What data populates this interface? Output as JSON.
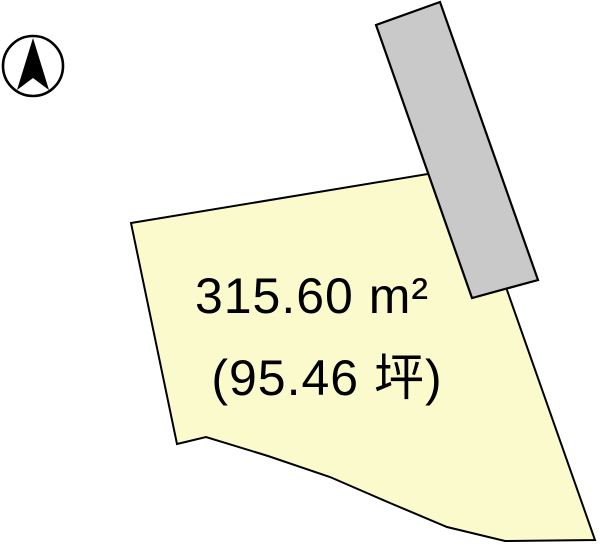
{
  "canvas": {
    "width_px": 600,
    "height_px": 545,
    "background_color": "#FFFFFF"
  },
  "compass": {
    "icon": "north-arrow-icon",
    "color": "#000000"
  },
  "plot": {
    "area_sqm_label": "315.60 m²",
    "area_tsubo_label": "(95.46 坪)",
    "area_sqm": 315.6,
    "area_tsubo": 95.46,
    "fill_color": "#FAFACD",
    "outline_color": "#000000",
    "text_color": "#000000"
  },
  "road": {
    "fill_color": "#C9C9C9",
    "outline_color": "#000000"
  }
}
